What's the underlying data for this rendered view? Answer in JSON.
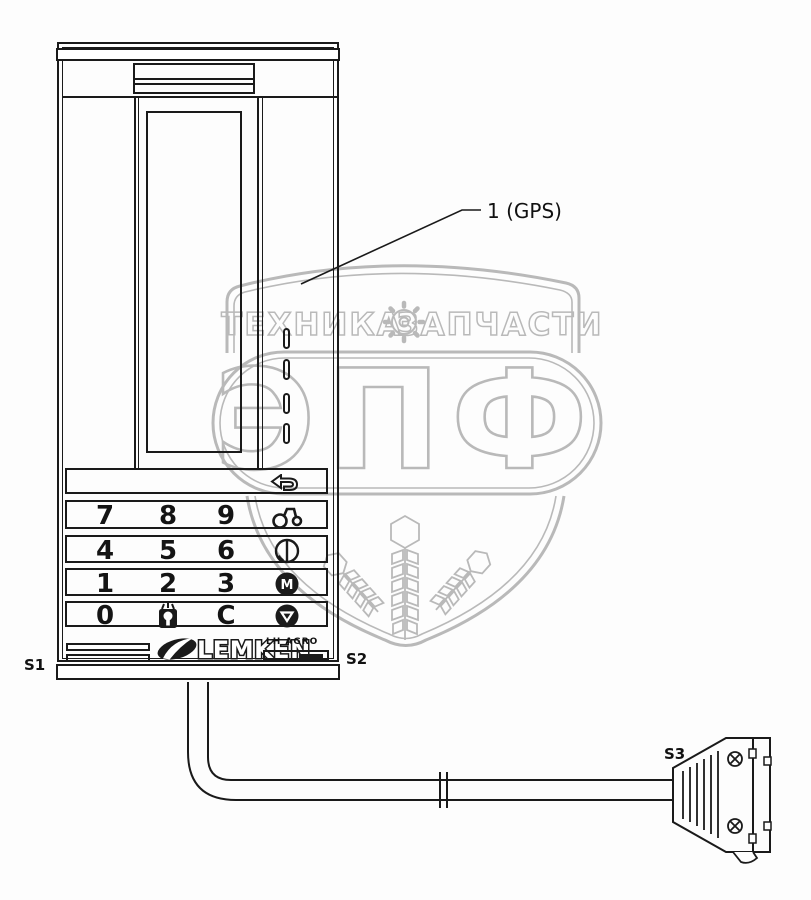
{
  "watermark": {
    "color": "#b9b9b9",
    "band_left": "ТЕХНИКА",
    "band_right": "ЗАПЧАСТИ",
    "big": "ЭПФ",
    "gear_icon": "gear-icon",
    "emblem_icons": [
      "wheat-ear-icon",
      "wheat-ear-icon",
      "wheat-ear-icon"
    ]
  },
  "callout": {
    "part_gps": "1 (GPS)"
  },
  "connector_labels": {
    "s1": "S1",
    "s2": "S2",
    "s3": "S3"
  },
  "terminal": {
    "brand": "LEMKEN",
    "brand_badge": "LH AGRO",
    "keys": {
      "k7": "7",
      "k8": "8",
      "k9": "9",
      "k4": "4",
      "k5": "5",
      "k6": "6",
      "k1": "1",
      "k2": "2",
      "k3": "3",
      "k0": "0",
      "kc": "C"
    },
    "icons": {
      "back": "back-arrow-icon",
      "hitch": "hitch-icon",
      "contrast": "contrast-circle-icon",
      "select": "m-circle-icon",
      "down": "down-triangle-circle-icon",
      "lamp": "lamp-icon",
      "brand_share": "lemken-share-icon"
    },
    "indicator_count": "4"
  }
}
